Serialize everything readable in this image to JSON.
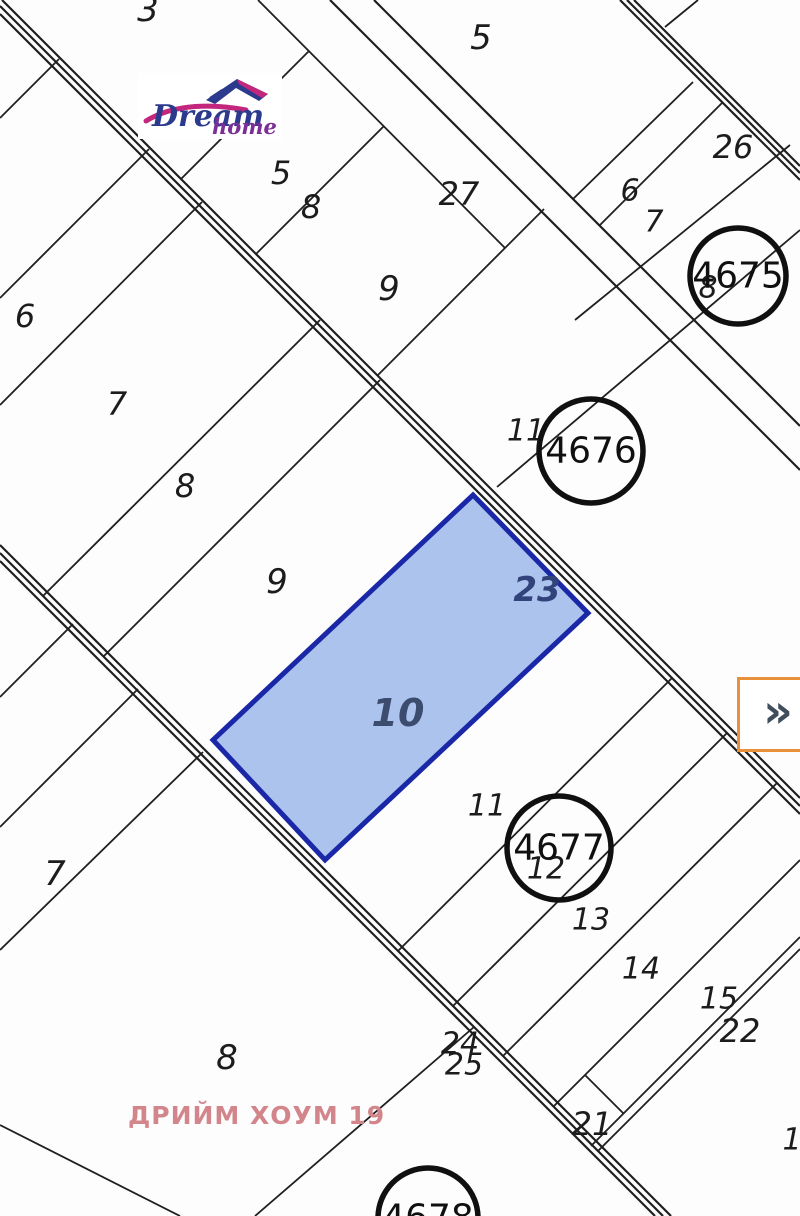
{
  "map": {
    "highlighted_parcel": {
      "number": "10",
      "corner_number": "23",
      "fill": "#acc3ee",
      "border": "#1a28a8"
    },
    "parcel_labels": [
      {
        "text": "3",
        "x": 148,
        "y": 10,
        "size": 34
      },
      {
        "text": "5",
        "x": 281,
        "y": 173,
        "size": 32
      },
      {
        "text": "8",
        "x": 311,
        "y": 207,
        "size": 32
      },
      {
        "text": "9",
        "x": 389,
        "y": 289,
        "size": 34
      },
      {
        "text": "27",
        "x": 459,
        "y": 194,
        "size": 32
      },
      {
        "text": "5",
        "x": 481,
        "y": 38,
        "size": 34
      },
      {
        "text": "6",
        "x": 630,
        "y": 191,
        "size": 30
      },
      {
        "text": "7",
        "x": 654,
        "y": 222,
        "size": 30
      },
      {
        "text": "26",
        "x": 733,
        "y": 147,
        "size": 32
      },
      {
        "text": "8",
        "x": 708,
        "y": 288,
        "size": 30
      },
      {
        "text": "6",
        "x": 25,
        "y": 316,
        "size": 32
      },
      {
        "text": "7",
        "x": 117,
        "y": 404,
        "size": 32
      },
      {
        "text": "8",
        "x": 185,
        "y": 486,
        "size": 32
      },
      {
        "text": "9",
        "x": 277,
        "y": 582,
        "size": 34
      },
      {
        "text": "11",
        "x": 526,
        "y": 431,
        "size": 30
      },
      {
        "text": "7",
        "x": 55,
        "y": 874,
        "size": 34
      },
      {
        "text": "8",
        "x": 227,
        "y": 1058,
        "size": 34
      },
      {
        "text": "11",
        "x": 487,
        "y": 806,
        "size": 30
      },
      {
        "text": "12",
        "x": 546,
        "y": 869,
        "size": 30
      },
      {
        "text": "13",
        "x": 591,
        "y": 920,
        "size": 30
      },
      {
        "text": "14",
        "x": 641,
        "y": 969,
        "size": 30
      },
      {
        "text": "15",
        "x": 719,
        "y": 999,
        "size": 30
      },
      {
        "text": "22",
        "x": 740,
        "y": 1031,
        "size": 32
      },
      {
        "text": "21",
        "x": 592,
        "y": 1124,
        "size": 32
      },
      {
        "text": "24",
        "x": 460,
        "y": 1044,
        "size": 30
      },
      {
        "text": "25",
        "x": 464,
        "y": 1065,
        "size": 30
      },
      {
        "text": "1",
        "x": 792,
        "y": 1140,
        "size": 30
      }
    ],
    "cadastral_circles": [
      {
        "id": "4675",
        "cx": 738,
        "cy": 276,
        "r": 48
      },
      {
        "id": "4676",
        "cx": 591,
        "cy": 451,
        "r": 52
      },
      {
        "id": "4677",
        "cx": 559,
        "cy": 848,
        "r": 52
      },
      {
        "id": "4678",
        "cx": 428,
        "cy": 1218,
        "r": 50
      }
    ],
    "logo": {
      "word1": "Dream",
      "word2": "home"
    },
    "watermark": "ДРИЙМ ХОУМ 19",
    "expand_button": {
      "glyph": "»"
    },
    "colors": {
      "line": "#1f1f1f",
      "highlight_fill": "#acc3ee",
      "highlight_border": "#1a28a8",
      "watermark": "#d2858a",
      "button_border": "#e8903a",
      "button_glyph": "#3f4e5a",
      "logo_navy": "#2b3a8c",
      "logo_magenta": "#c2267d",
      "logo_purple": "#7c2f96"
    }
  }
}
